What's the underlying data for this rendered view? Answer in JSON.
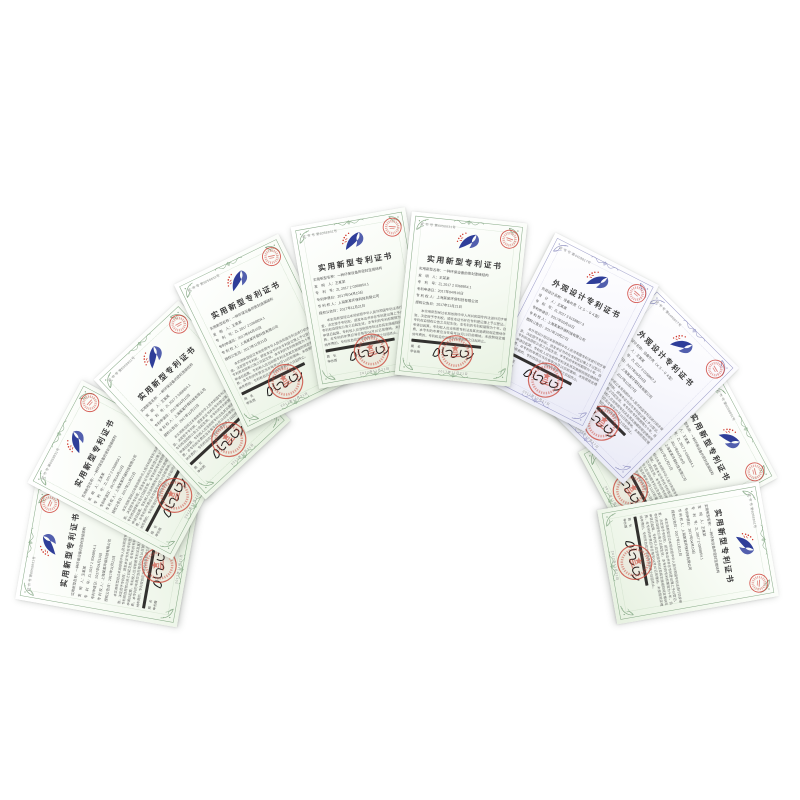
{
  "page": {
    "background_color": "#ffffff",
    "description": "十本专利证书呈扇形排列"
  },
  "colors": {
    "utility_border": "#85a885",
    "design_border": "#9899c6",
    "seal_red": "#cc4a3d",
    "logo_blue": "#2f3e99",
    "logo_red": "#d03a2e"
  },
  "cert_types": {
    "utility": {
      "title": "实用新型专利证书",
      "cert_no": "证 书 号 第6058831号",
      "fields": [
        "实用新型名称：一种环保设备的密封连接结构",
        "发　明　人：王某某",
        "专　利　号：ZL 2017 2 0368854.1",
        "专利申请日：2017年04月10日",
        "专 利 权 人：上海某某环保科技有限公司",
        "授权公告日：2017年11月21日"
      ],
      "body": "本实用新型经过本局依照中华人民共和国专利法进行初步审查，决定授予专利权，颁发本证书并在专利登记簿上予以登记。专利权自授权公告之日起生效。本专利的专利权期限为十年，自申请日起算。专利权人应当依照专利法及其实施细则规定缴纳年费，本专利的年费应当在每年04月10日前缴纳。未按照规定缴纳年费的，专利权自应当缴纳年费期满之日起终止。",
      "signer_title": "局　长",
      "signer_name": "申长雨",
      "date": "2017年11月21日"
    },
    "design": {
      "title": "外观设计专利证书",
      "cert_no": "证 书 号 第4408817号",
      "fields": [
        "外观设计名称：设备外壳（ＸＳ－０４型）",
        "设　计　人：王某某",
        "专　利　号：ZL 2017 3 0158867.3",
        "专利申请日：2017年05月16日",
        "专 利 权 人：上海某某环保科技有限公司",
        "授权公告日：2017年10月27日"
      ],
      "body": "本外观设计经过本局依照中华人民共和国专利法进行初步审查，决定授予专利权，颁发本证书并在专利登记簿上予以登记。专利权自授权公告之日起生效。本专利的专利权期限为十年，自申请日起算。专利权人应当依照专利法及其实施细则规定缴纳年费，本专利的年费应当在每年05月16日前缴纳。未按照规定缴纳年费的，专利权自应当缴纳年费期满之日起终止。",
      "signer_title": "局　长",
      "signer_name": "申长雨",
      "date": "2017年10月27日"
    }
  },
  "certificates": [
    {
      "type": "utility"
    },
    {
      "type": "utility"
    },
    {
      "type": "utility"
    },
    {
      "type": "utility"
    },
    {
      "type": "utility"
    },
    {
      "type": "utility"
    },
    {
      "type": "design"
    },
    {
      "type": "design"
    },
    {
      "type": "utility"
    },
    {
      "type": "utility"
    }
  ]
}
